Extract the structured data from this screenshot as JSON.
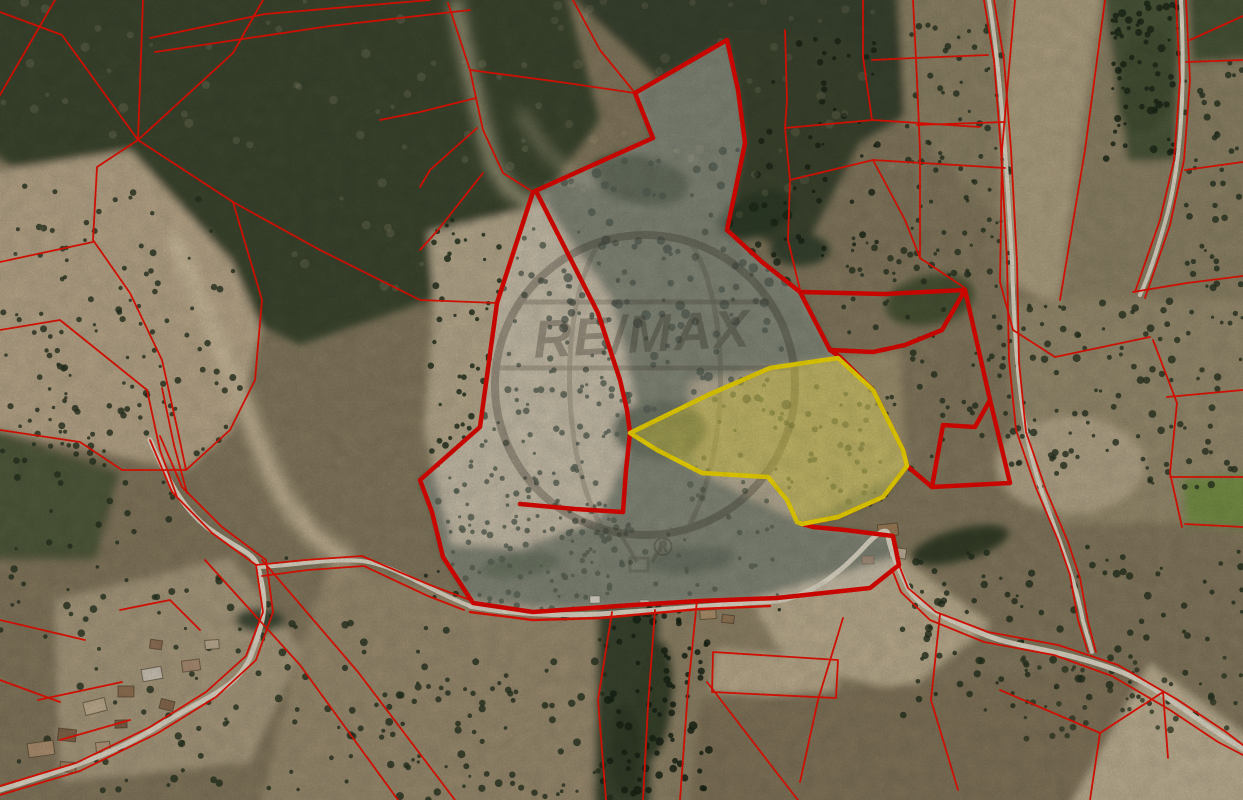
{
  "map": {
    "description": "aerial-cadastral-parcels-view",
    "watermark": {
      "brand": "RE/MAX",
      "registered_mark": "®"
    },
    "colors": {
      "parcel_line": "#fb1405",
      "property_boundary": "#f30800",
      "highlight_stroke": "#ffe501",
      "highlight_fill": "rgba(224,210,68,0.50)",
      "property_film": "rgba(255,255,255,0.28)",
      "road": "#ece5d3",
      "watermark_ink": "#3a352a"
    }
  }
}
